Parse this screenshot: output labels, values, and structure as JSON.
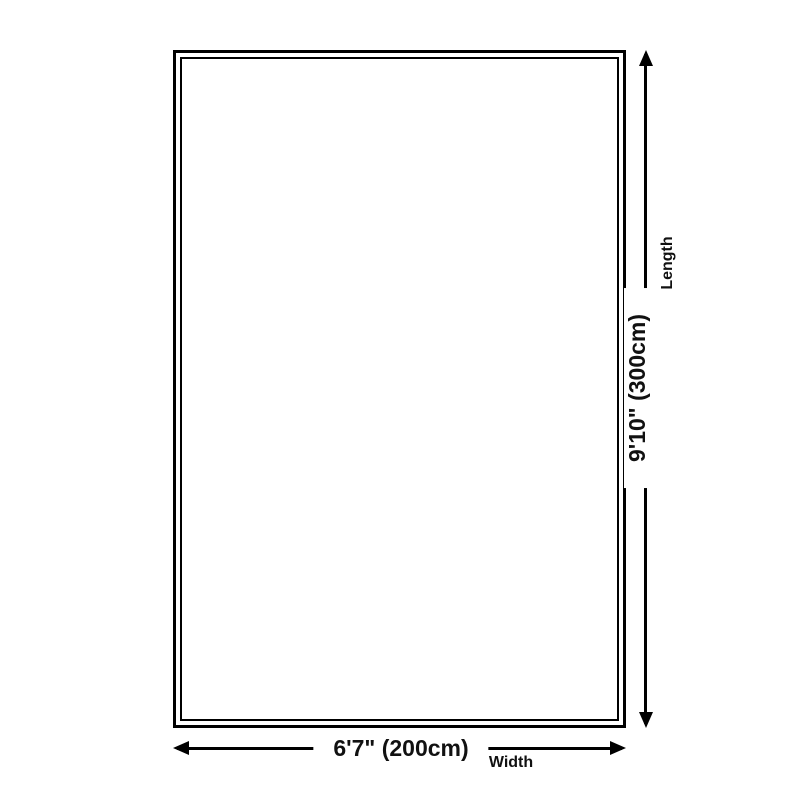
{
  "diagram": {
    "type": "product-dimension-diagram",
    "length": {
      "value": "9'10\" (300cm)",
      "label": "Length",
      "orientation": "vertical"
    },
    "width": {
      "value": "6'7\" (200cm)",
      "label": "Width",
      "orientation": "horizontal"
    },
    "colors": {
      "line": "#000000",
      "text": "#111111",
      "background": "#ffffff"
    }
  }
}
